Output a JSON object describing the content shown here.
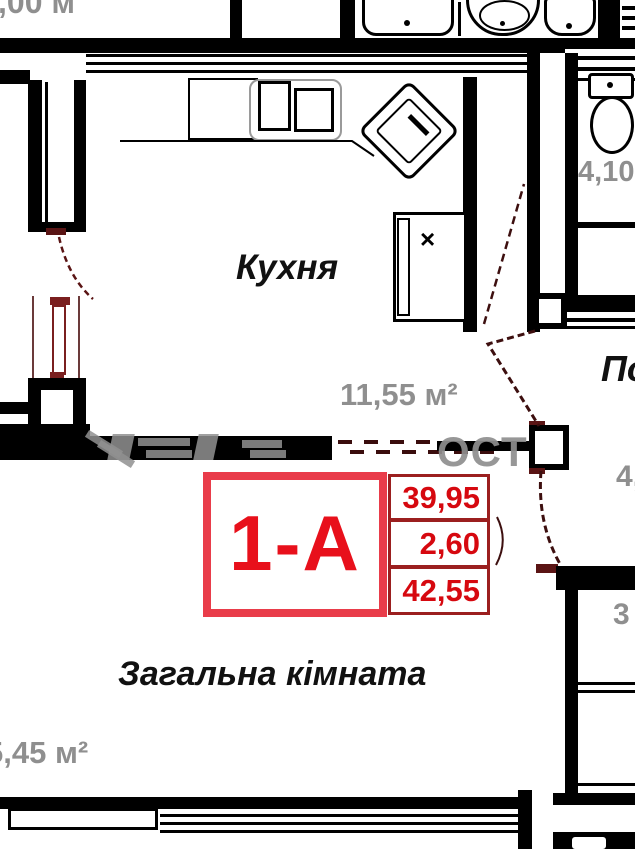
{
  "plan": {
    "title": "apartment floor plan 1-A",
    "unit_box": {
      "unit_label": "1-А",
      "values": [
        "39,95",
        "2,60",
        "42,55"
      ]
    },
    "rooms": {
      "kitchen": {
        "name": "Кухня",
        "area": "11,55 м²"
      },
      "living": {
        "name": "Загальна кімната",
        "area": "5,45 м²"
      },
      "bathroom": {
        "area": "4,10"
      },
      "hallway": {
        "name_partial": "По",
        "area_partial": "4,"
      },
      "closet": {
        "area_partial": "3"
      },
      "edge_top_left": {
        "area_partial": ",00 м"
      }
    },
    "marks": {
      "appliance_x": "×"
    },
    "watermark": {
      "fragment": "ОСТ"
    },
    "colors": {
      "wall": "#000000",
      "accent_red": "#e93c4a",
      "deep_red": "#d6080f",
      "label_gray": "#8f8f8f",
      "door_maroon": "#5a1414"
    }
  }
}
